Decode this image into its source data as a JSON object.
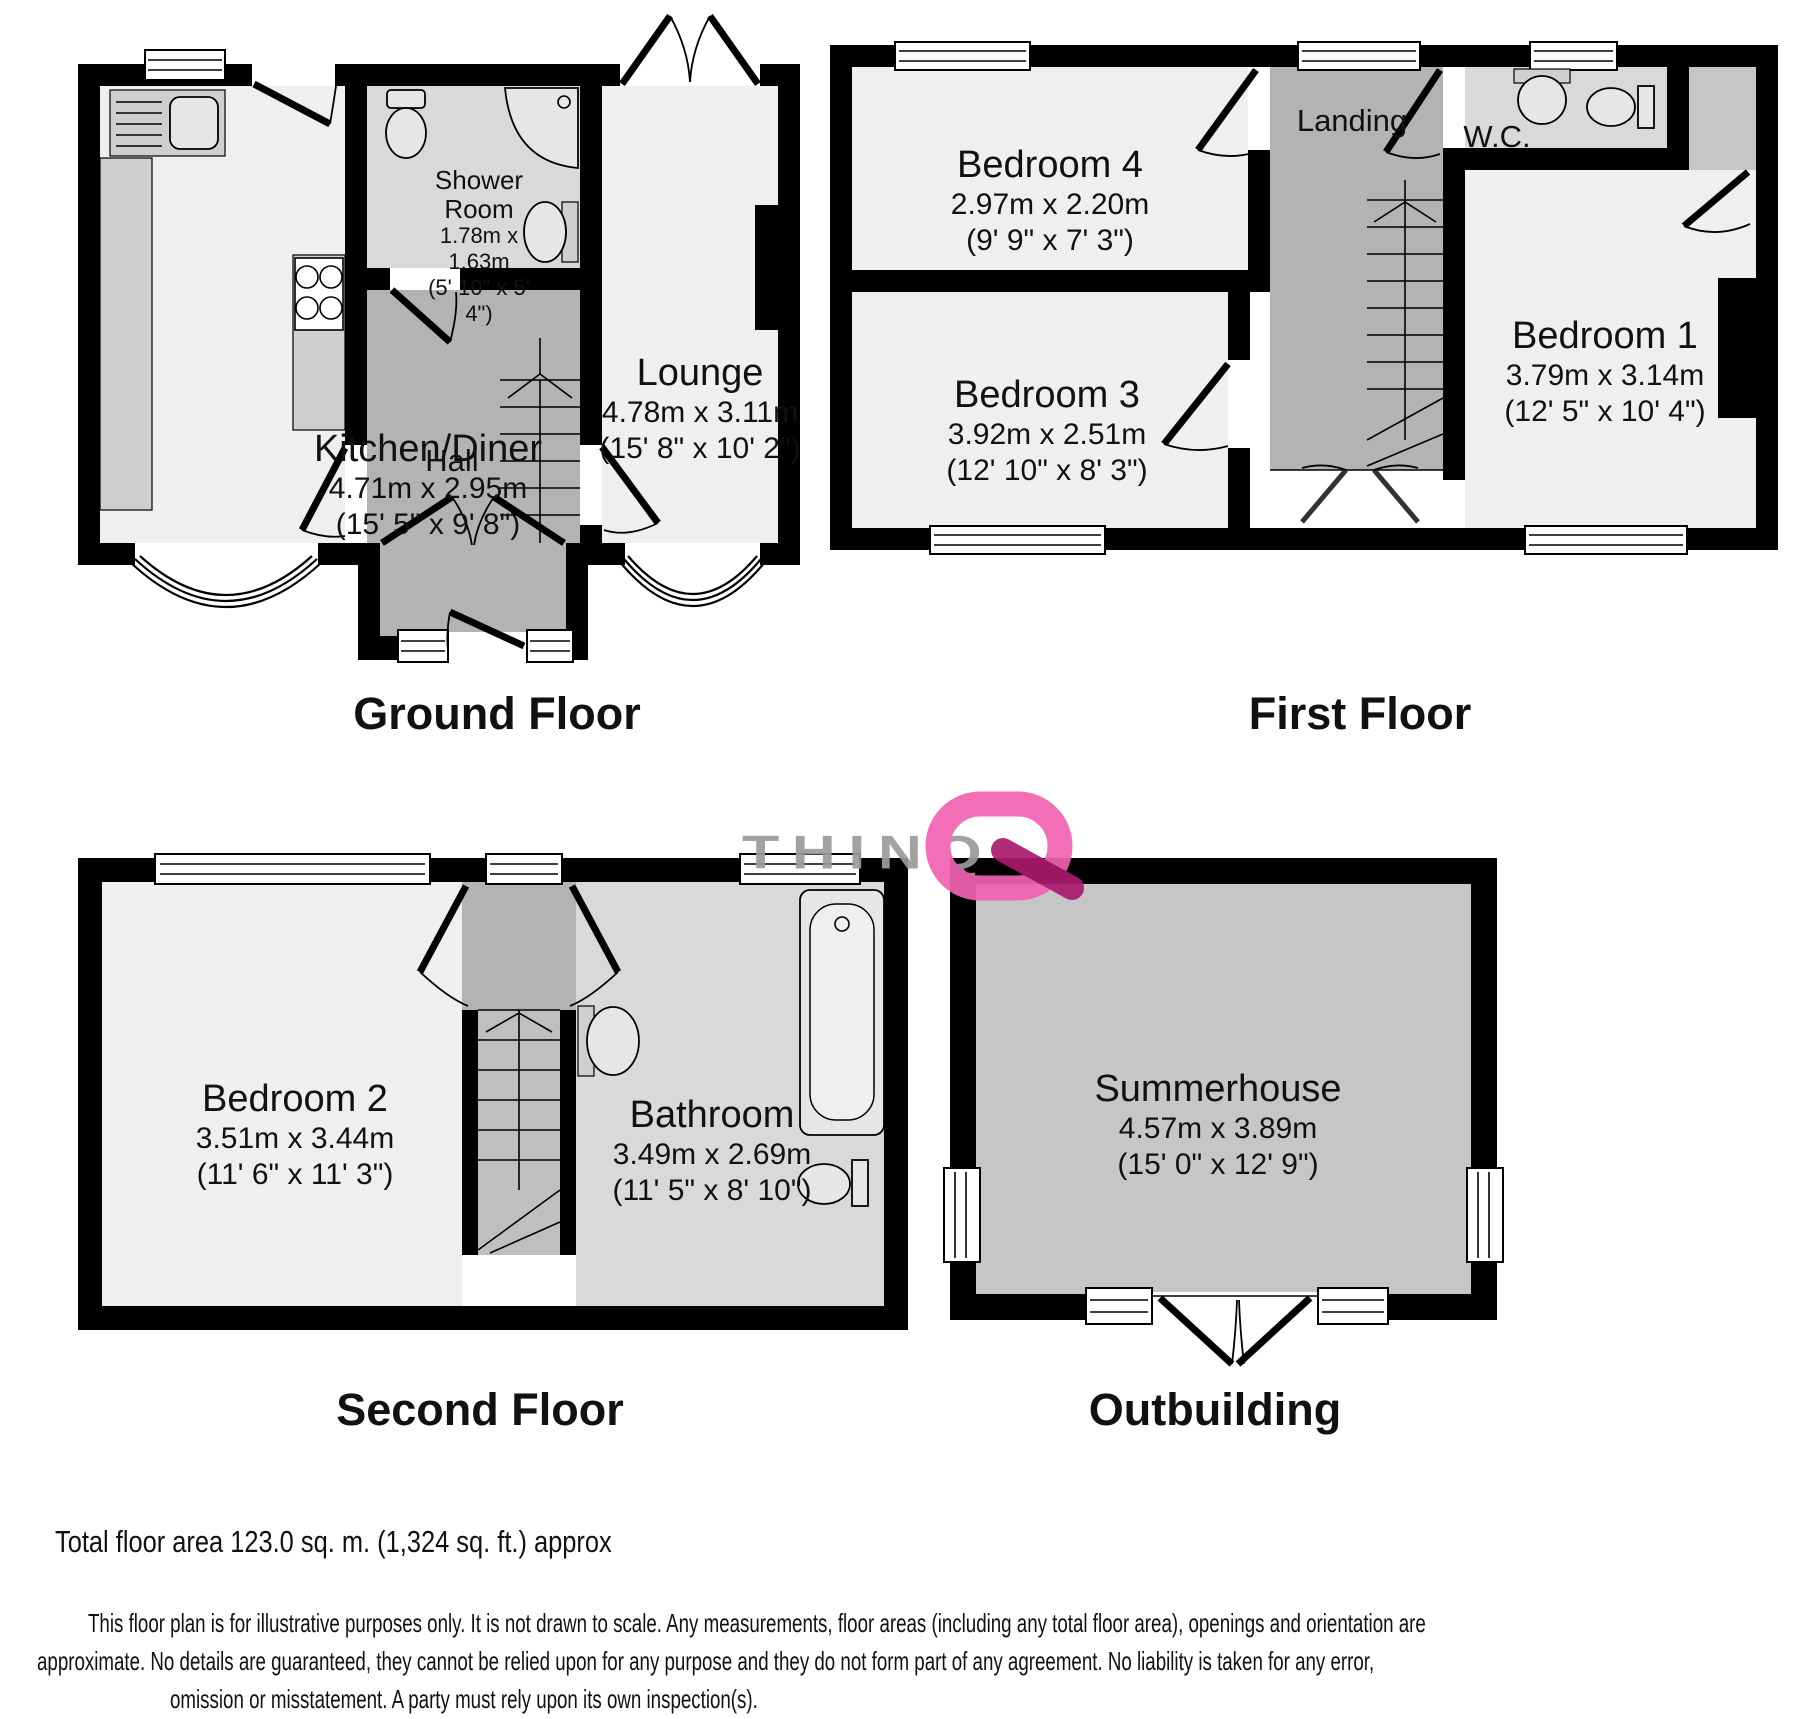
{
  "ground": {
    "title": "Ground Floor",
    "kitchen": {
      "name": "Kitchen/Diner",
      "metric": "4.71m x 2.95m",
      "imperial": "(15' 5\" x 9' 8\")"
    },
    "hall": {
      "name": "Hall"
    },
    "shower": {
      "name": "Shower Room",
      "metric": "1.78m x 1.63m",
      "imperial": "(5' 10\" x 5' 4\")"
    },
    "lounge": {
      "name": "Lounge",
      "metric": "4.78m x 3.11m",
      "imperial": "(15' 8\" x 10' 2\")"
    }
  },
  "first": {
    "title": "First Floor",
    "bedroom4": {
      "name": "Bedroom 4",
      "metric": "2.97m x 2.20m",
      "imperial": "(9' 9\" x 7' 3\")"
    },
    "landing": {
      "name": "Landing"
    },
    "wc": {
      "name": "W.C."
    },
    "bedroom1": {
      "name": "Bedroom 1",
      "metric": "3.79m x 3.14m",
      "imperial": "(12' 5\" x 10' 4\")"
    },
    "bedroom3": {
      "name": "Bedroom 3",
      "metric": "3.92m x 2.51m",
      "imperial": "(12' 10\" x 8' 3\")"
    }
  },
  "second": {
    "title": "Second Floor",
    "bedroom2": {
      "name": "Bedroom 2",
      "metric": "3.51m x 3.44m",
      "imperial": "(11' 6\" x 11' 3\")"
    },
    "bathroom": {
      "name": "Bathroom",
      "metric": "3.49m x 2.69m",
      "imperial": "(11' 5\" x 8' 10\")"
    }
  },
  "outbuilding": {
    "title": "Outbuilding",
    "summerhouse": {
      "name": "Summerhouse",
      "metric": "4.57m x 3.89m",
      "imperial": "(15' 0\" x 12' 9\")"
    }
  },
  "watermark": {
    "text": "THINQ"
  },
  "footer": {
    "total_area": "Total floor area 123.0 sq. m. (1,324 sq. ft.) approx",
    "disclaimer": [
      "This floor plan is for illustrative purposes only. It is not drawn to scale. Any measurements, floor areas (including any total floor area), openings and orientation are",
      "approximate. No details are guaranteed, they cannot be relied upon for any purpose and they do not form part of any agreement. No liability is taken for any error,",
      "omission or misstatement. A party must rely upon its own inspection(s)."
    ]
  },
  "colors": {
    "wall": "#000000",
    "room_light": "#efefef",
    "hall_gray": "#b3b3b3",
    "bath_gray": "#d9d9d9",
    "summerhouse_gray": "#c6c6c6",
    "watermark_gray": "#9b9b9b",
    "watermark_pink": "#f163b2",
    "watermark_dark_pink": "#aa1a6d"
  }
}
